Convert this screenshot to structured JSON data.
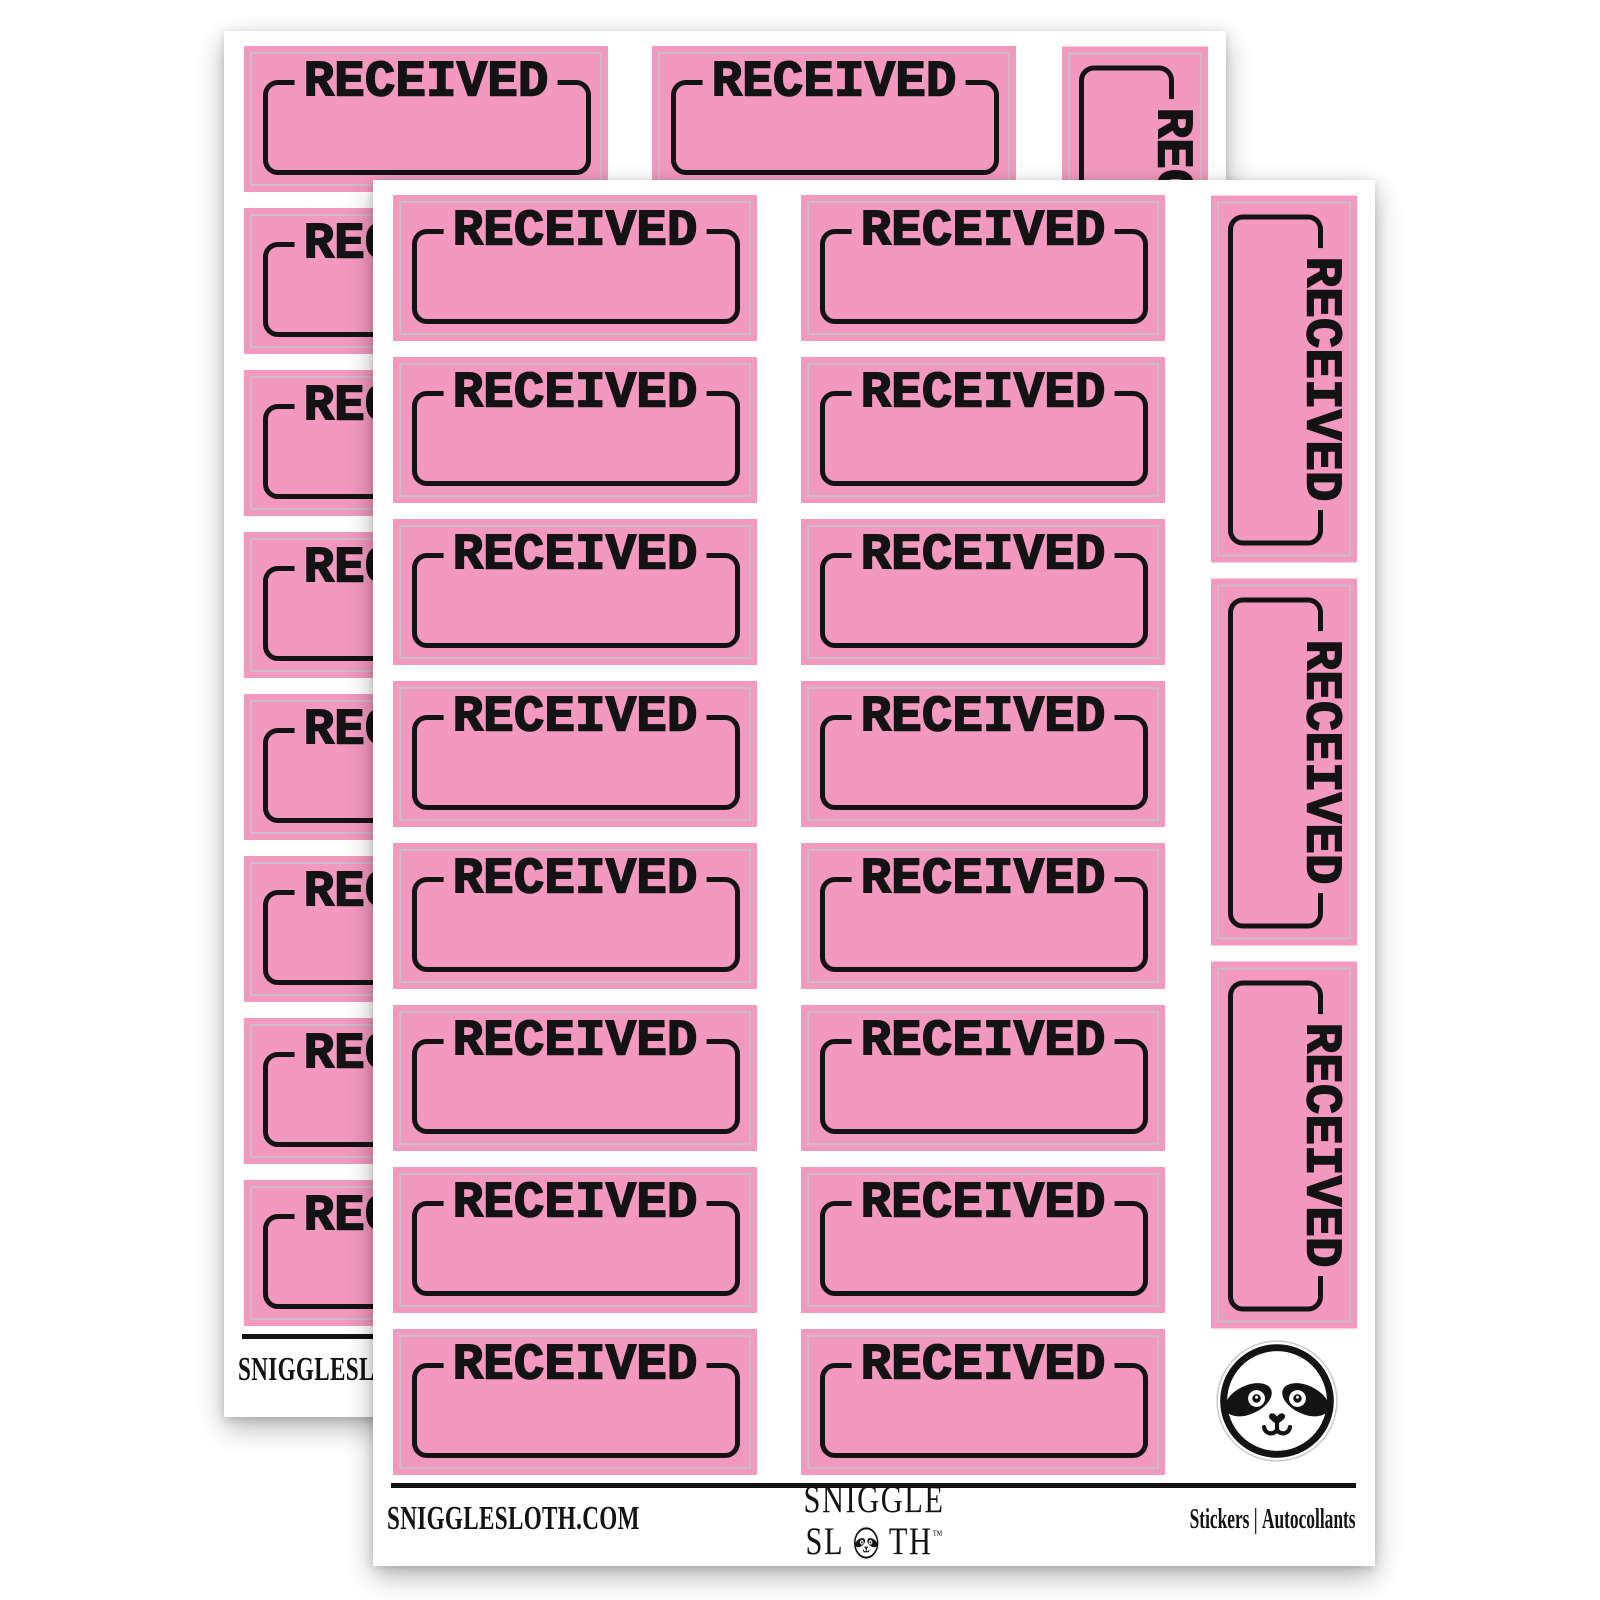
{
  "product": {
    "sticker_label": "RECEIVED",
    "colors": {
      "pink": "#F399BF",
      "ink": "#131313",
      "cut_line": "#C9BEC5"
    }
  },
  "sheet": {
    "grid": {
      "horizontal_columns": 2,
      "rows_per_column": 8,
      "vertical_stickers": 3
    },
    "badge_icon": "sloth-face-icon",
    "footer": {
      "website": "SNIGGLESLOTH.COM",
      "brand": {
        "line1": "SNIGGLE",
        "line2_pre": "SL",
        "line2_o_icon": "sloth-face-icon",
        "line2_post": "TH",
        "trademark": "™"
      },
      "right": {
        "en": "Stickers",
        "separator": "|",
        "fr": "Autocollants"
      }
    }
  },
  "sheets": [
    {
      "position": "back"
    },
    {
      "position": "front"
    }
  ]
}
